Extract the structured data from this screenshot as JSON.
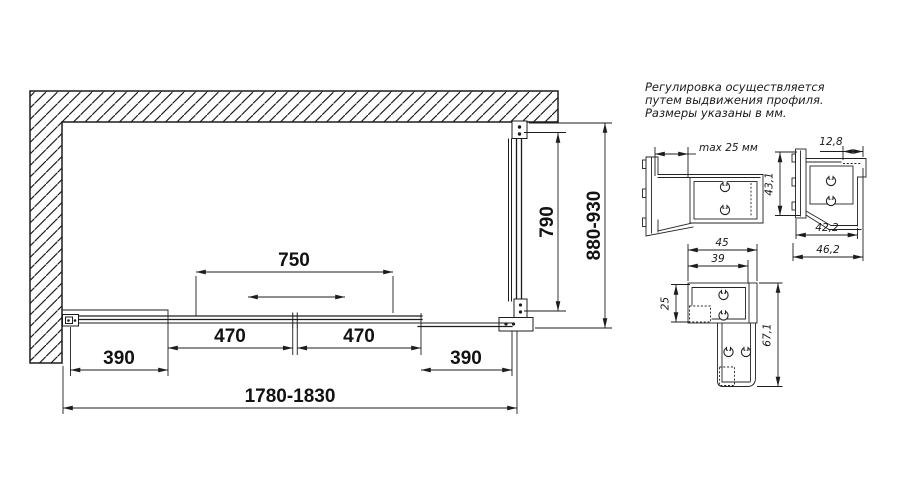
{
  "note": {
    "line1": "Регулировка осуществляется",
    "line2": "путем выдвижения профиля.",
    "line3": "Размеры указаны в мм."
  },
  "plan_view": {
    "door_travel": "750",
    "side_panel_glass_height": "790",
    "depth_range": "880-930",
    "left_fixed_panel": "390",
    "left_door": "470",
    "right_door": "470",
    "right_fixed_panel": "390",
    "width_range": "1780-1830"
  },
  "profile_details": {
    "wall_profile": {
      "max_extension": "max 25 мм"
    },
    "upper_corner_profile": {
      "notch_width": "12,8",
      "height": "43,1",
      "inner_width": "42,2",
      "outer_width": "46,2"
    },
    "lower_corner_profile": {
      "outer_width": "45",
      "inner_width": "39",
      "arm_height": "25",
      "total_height": "67,1"
    }
  },
  "colors": {
    "line": "#1d1d1d",
    "background": "#ffffff"
  }
}
